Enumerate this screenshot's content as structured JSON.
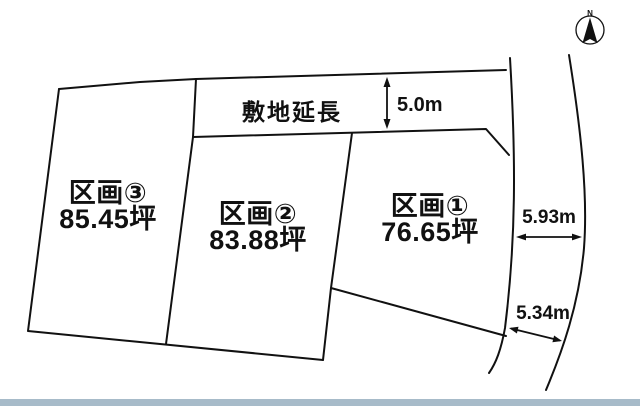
{
  "compass": {
    "north_label": "N"
  },
  "site_extension": {
    "label": "敷地延長",
    "width_dim": "5.0m"
  },
  "plots": [
    {
      "name": "区画①",
      "area": "76.65坪"
    },
    {
      "name": "区画②",
      "area": "83.88坪"
    },
    {
      "name": "区画③",
      "area": "85.45坪"
    }
  ],
  "road_dims": {
    "upper": "5.93m",
    "lower": "5.34m"
  },
  "colors": {
    "line": "#111111",
    "text": "#111111",
    "footer_bar": "#a7bbc9",
    "background": "#ffffff"
  }
}
